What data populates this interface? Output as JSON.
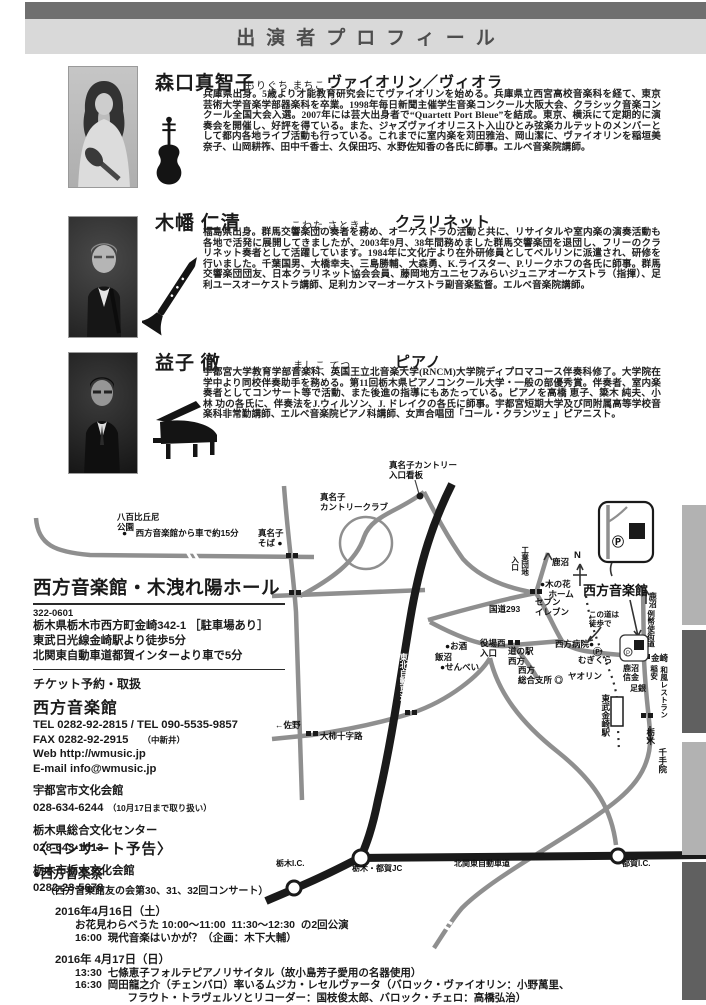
{
  "header": {
    "title": "出演者プロフィール"
  },
  "profiles": [
    {
      "name": "森口真智子",
      "kana": "もりぐち まちこ",
      "instrument": "ヴァイオリン／ヴィオラ",
      "bio": "兵庫県出身。5歳より才能教育研究会にてヴァイオリンを始める。兵庫県立西宮高校音楽科を経て、東京芸術大学音楽学部器楽科を卒業。1998年毎日新聞主催学生音楽コンクール大阪大会、クラシック音楽コンクール全国大会入選。2007年には芸大出身者で“Quartett Port Bleue”を結成。東京、横浜にて定期的に演奏会を開催し、好評を得ている。また、ジャズヴァイオリニスト入山ひとみ弦楽カルテットのメンバーとして都内各地ライブ活動も行っている。これまでに室内楽を苅田雅治、岡山潔に、ヴァイオリンを稲垣美奈子、山岡耕筰、田中千香士、久保田巧、水野佐知香の各氏に師事。エルベ音楽院講師。"
    },
    {
      "name": "木幡 仁清",
      "kana": "こわた さときよ",
      "instrument": "クラリネット",
      "bio": "福島県出身。群馬交響楽団の奏者を務め、オーケストラの活動と共に、リサイタルや室内楽の演奏活動も各地で活発に展開してきましたが、2003年9月、38年間務めました群馬交響楽団を退団し、フリーのクラリネット奏者として活躍しています。1984年に文化庁より在外研修員としてベルリンに派遣され、研修を行いました。千葉国男、大橋幸夫、三島勝輔、大森勇、K.ライスター、P.リークホフの各氏に師事。群馬交響楽団団友、日本クラリネット協会会員、藤岡地方ユニセフみらいジュニアオーケストラ（指揮）、足利ユースオーケストラ講師、足利カンマーオーケストラ副音楽監督。エルベ音楽院講師。"
    },
    {
      "name": "益子 徹",
      "kana": "ましこ てつ",
      "instrument": "ピアノ",
      "bio": "宇都宮大学教育学部音楽科、英国王立北音楽大学(RNCM)大学院ディプロマコース伴奏科修了。大学院在学中より同校伴奏助手を務める。第11回栃木県ピアノコンクール大学・一般の部優秀賞。伴奏者、室内楽奏者としてコンサート等で活動、また後進の指導にもあたっている。ピアノを高橋 恵子、簗木 純夫、小林 功の各氏に、伴奏法をJ.ウィルソン、J. ドレイクの各氏に師事。宇都宮短期大学及び同附属高等学校音楽科非常勤講師、エルベ音楽院ピアノ科講師、女声合唱団「コール・クランツェ 」ピアニスト。"
    }
  ],
  "venue": {
    "title": "西方音楽館・木洩れ陽ホール",
    "postal_code": "322-0601",
    "address": "栃木県栃木市西方町金崎342-1 ［駐車場あり］",
    "access_train": "東武日光線金崎駅より徒歩5分",
    "access_car": "北関東自動車道都賀インターより車で5分",
    "ticket_heading": "チケット予約・取扱",
    "main_outlet": {
      "name": "西方音楽館",
      "tel": "TEL 0282-92-2815 / TEL 090-5535-9857",
      "fax": "FAX 0282-92-2915",
      "fax_note": "（中新井）",
      "web": "Web  http://wmusic.jp",
      "email": "E-mail  info@wmusic.jp"
    },
    "other_outlets": [
      {
        "name": "宇都宮市文化会館",
        "phone": "028-634-6244",
        "note": "（10月17日まで取り扱い）"
      },
      {
        "name": "栃木県総合文化センター",
        "phone": "028-643-1013",
        "note": ""
      },
      {
        "name": "栃木市栃木文化会館",
        "phone": "0282-23-5678",
        "note": ""
      }
    ]
  },
  "announcements": {
    "heading": "〈コンサート予告〉",
    "festival": "●西方音楽祭",
    "festival_sub": "（西方音楽館友の会第30、31、32回コンサート）",
    "days": [
      {
        "date": "2016年4月16日（土）",
        "events": [
          "お花見わらべうた 10:00～11:00  11:30～12:30  の2回公演",
          "16:00  現代音楽はいかが？（企画：木下大輔）"
        ]
      },
      {
        "date": "2016年 4月17日（日）",
        "events": [
          "13:30  七條恵子フォルテピアノリサイタル（故小島芳子愛用の名器使用）",
          "16:30  岡田龍之介（チェンバロ）率いるムジカ・レセルヴァータ（バロック・ヴァイオリン：小野萬里、",
          "　　　　　フラウト・トラヴェルソとリコーダー：国枝俊太郎、バロック・チェロ：高橋弘治）"
        ]
      }
    ]
  },
  "map": {
    "labels": [
      {
        "t": "真名子カントリー\n入口看板",
        "x": 389,
        "y": 461,
        "s": 8.5
      },
      {
        "t": "八百比丘尼\n公園",
        "x": 117,
        "y": 513,
        "s": 8.5
      },
      {
        "t": "●　西方音楽館から車で約15分",
        "x": 122,
        "y": 529,
        "s": 8.5
      },
      {
        "t": "真名子\nカントリークラブ",
        "x": 320,
        "y": 493,
        "s": 8.5
      },
      {
        "t": "真名子\nそば ●",
        "x": 258,
        "y": 529,
        "s": 8.5
      },
      {
        "t": "入口",
        "x": 510,
        "y": 556,
        "v": 1,
        "s": 7.5
      },
      {
        "t": "工業団地",
        "x": 520,
        "y": 546,
        "v": 1,
        "s": 7.5
      },
      {
        "t": "鹿沼",
        "x": 552,
        "y": 558,
        "s": 8.5
      },
      {
        "t": "N",
        "x": 574,
        "y": 551,
        "s": 9.5
      },
      {
        "t": "●木の花\n　ホーム",
        "x": 540,
        "y": 580,
        "s": 8.5
      },
      {
        "t": "セブン\nイレブン",
        "x": 535,
        "y": 598,
        "s": 8.5
      },
      {
        "t": "国道293",
        "x": 489,
        "y": 605,
        "s": 8.5
      },
      {
        "t": "西方音楽館",
        "x": 583,
        "y": 584,
        "s": 13
      },
      {
        "t": "鹿沼",
        "x": 648,
        "y": 592,
        "v": 1,
        "s": 8
      },
      {
        "t": "例幣使街道",
        "x": 646,
        "y": 610,
        "v": 1,
        "s": 7.5
      },
      {
        "t": "この道は\n徒歩で",
        "x": 589,
        "y": 611,
        "s": 7.5
      },
      {
        "t": "西方病院●",
        "x": 555,
        "y": 640,
        "s": 8.5
      },
      {
        "t": "役場西\n入口",
        "x": 480,
        "y": 639,
        "s": 8.5
      },
      {
        "t": "道の駅\n西方",
        "x": 508,
        "y": 647,
        "s": 8.5
      },
      {
        "t": "●お酒",
        "x": 445,
        "y": 642,
        "s": 8.5
      },
      {
        "t": "飯沼",
        "x": 435,
        "y": 653,
        "s": 8.5
      },
      {
        "t": "●せんべい",
        "x": 440,
        "y": 663,
        "s": 8.5
      },
      {
        "t": "西方\n総合支所 ◎",
        "x": 518,
        "y": 666,
        "s": 8.5
      },
      {
        "t": "Ⓟ",
        "x": 593,
        "y": 647,
        "s": 9
      },
      {
        "t": "むぎくら",
        "x": 578,
        "y": 656,
        "s": 8.5
      },
      {
        "t": "ヤオリン",
        "x": 568,
        "y": 672,
        "s": 8.5
      },
      {
        "t": "金崎",
        "x": 651,
        "y": 654,
        "s": 8.5
      },
      {
        "t": "鹿沼\n信金",
        "x": 623,
        "y": 664,
        "s": 8
      },
      {
        "t": "稲安",
        "x": 649,
        "y": 665,
        "v": 1,
        "s": 7.5
      },
      {
        "t": "和風レストラン",
        "x": 659,
        "y": 666,
        "v": 1,
        "s": 7.5
      },
      {
        "t": "足銀",
        "x": 630,
        "y": 684,
        "s": 8
      },
      {
        "t": "東武金崎駅",
        "x": 600,
        "y": 694,
        "v": 1,
        "s": 8.5
      },
      {
        "t": "栃木",
        "x": 645,
        "y": 728,
        "v": 1,
        "s": 8.5
      },
      {
        "t": "千手院",
        "x": 657,
        "y": 748,
        "v": 1,
        "s": 8.5
      },
      {
        "t": "←佐野",
        "x": 275,
        "y": 721,
        "s": 8.5
      },
      {
        "t": "大柿十字路",
        "x": 320,
        "y": 732,
        "s": 8.5
      },
      {
        "t": "東北自動車道",
        "x": 399,
        "y": 653,
        "v": 1,
        "s": 8,
        "c": "#ffffff"
      },
      {
        "t": "北関東自動車道",
        "x": 454,
        "y": 859,
        "s": 8
      },
      {
        "t": "栃木I.C.",
        "x": 276,
        "y": 859,
        "s": 8
      },
      {
        "t": "栃木・都賀JC",
        "x": 352,
        "y": 864,
        "s": 8
      },
      {
        "t": "都賀I.C.",
        "x": 622,
        "y": 859,
        "s": 8
      },
      {
        "t": "Ⓟ",
        "x": 612,
        "y": 536,
        "s": 12
      }
    ]
  },
  "colors": {
    "header_dark": "#6f6f6f",
    "header_light": "#d9d9d9",
    "tab_light": "#b2b2b2",
    "tab_dark": "#606060",
    "road_gray": "#8f8f8f",
    "expressway_black": "#1a1a1a"
  }
}
